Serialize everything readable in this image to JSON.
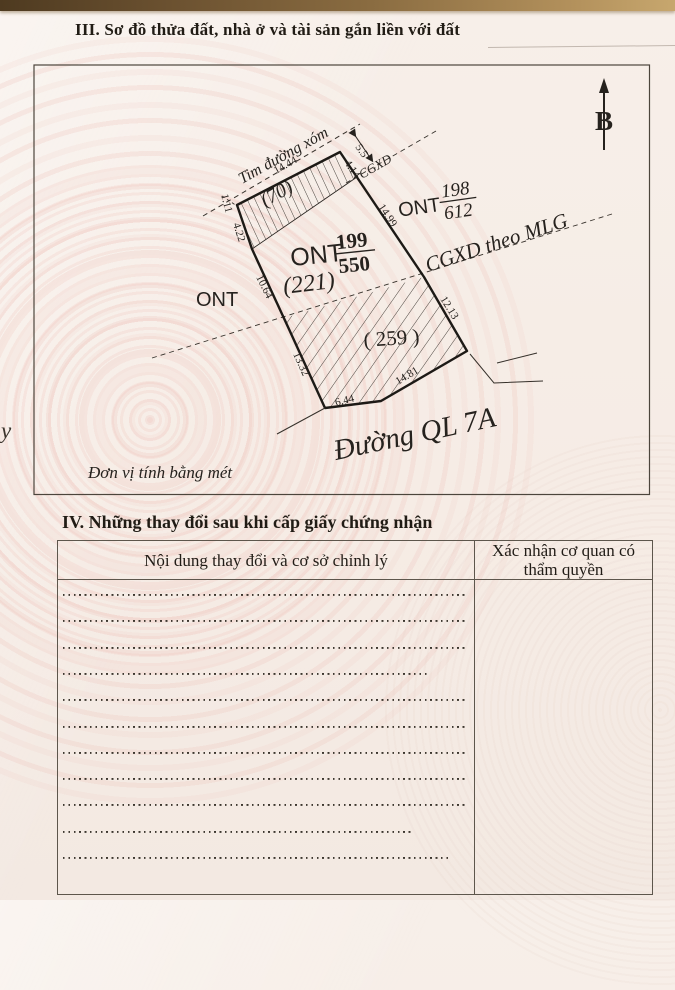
{
  "page": {
    "section3_title": "III. Sơ đồ thửa đất, nhà ở và tài sản gắn liền với đất",
    "section4_title": "IV. Những thay đổi sau khi cấp giấy chứng nhận",
    "stray_edge_text": "y"
  },
  "diagram": {
    "unit_note": "Đơn vị tính bằng mét",
    "north_label": "B",
    "road_centerline_label": "Tim đường xóm",
    "road_name": "Đường QL 7A",
    "mlg_line_label": "CGXD theo MLG",
    "cgxd_label": "CGXD",
    "parcels": {
      "strip_area": "(70)",
      "left_land_type": "ONT",
      "hatched_area": "( 259 )",
      "main": {
        "land_type": "ONT",
        "number": "199",
        "area": "550",
        "note": "(221)"
      },
      "neighbor": {
        "land_type": "ONT",
        "number": "198",
        "area": "612"
      }
    },
    "measurements": {
      "top": "14.44",
      "strip_right": "4.14",
      "corner": "1.11",
      "left_upper": "4.22",
      "left_mid": "10.64",
      "left_lower": "13.32",
      "bottom_left": "6.44",
      "bottom_right": "14.81",
      "right_lower": "12.13",
      "right_upper": "14.99",
      "setback": "5.5"
    }
  },
  "table": {
    "col1_header": "Nội dung thay đổi và cơ sở chỉnh lý",
    "col2_header": "Xác nhận cơ quan có thẩm quyền",
    "row_widths": [
      100,
      100,
      100,
      90,
      100,
      100,
      100,
      100,
      100,
      86,
      95
    ]
  },
  "colors": {
    "paper": "#f6ede7",
    "ink": "#26221e",
    "pattern_pink": "#eec8c0",
    "desk_brown": "#8a6c41"
  }
}
